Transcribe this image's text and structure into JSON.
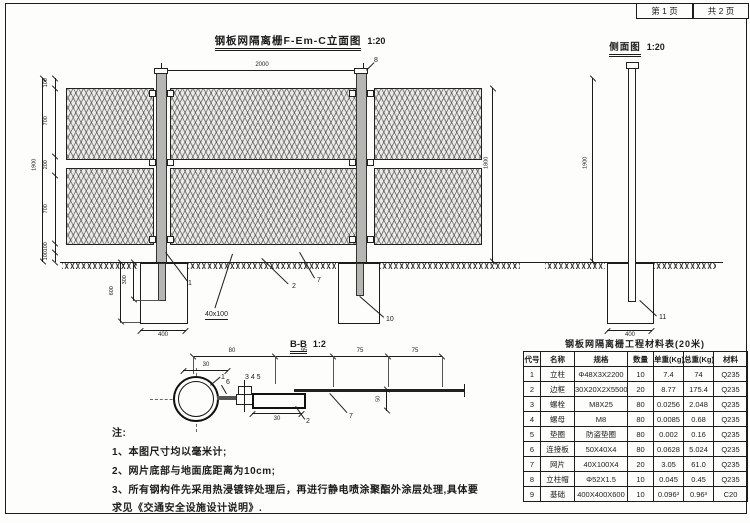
{
  "sheet": {
    "page_no": "第 1 页",
    "page_total": "共 2 页"
  },
  "elevation": {
    "title": "钢板网隔离栅F-Em-C立面图",
    "scale": "1:20",
    "dims": {
      "top_width": "2000",
      "total_height": "1900",
      "chain": [
        "100",
        "700",
        "200",
        "700",
        "100",
        "100"
      ],
      "mesh_height": "1800",
      "foundation_depth": "600",
      "post_embed": "300",
      "foundation_width": "400",
      "mesh_opening": "40x100"
    },
    "callouts": {
      "post": "1",
      "frame": "2",
      "mesh": "7",
      "post_cap": "8",
      "foundation": "10"
    }
  },
  "side_view": {
    "title": "侧面图",
    "scale": "1:20",
    "dims": {
      "post_height": "1900",
      "foundation_width": "400"
    },
    "callouts": {
      "foundation": "11"
    }
  },
  "section_bb": {
    "title": "B-B",
    "scale": "1:2",
    "dims": {
      "top": [
        "80",
        "95",
        "75",
        "75"
      ],
      "offset_top": "30",
      "frame_width": "30",
      "overlap": "50"
    },
    "callouts": {
      "post": "1",
      "frame": "2",
      "bolt_set": "3 4 5",
      "plate": "6",
      "mesh": "7"
    }
  },
  "notes": {
    "heading": "注:",
    "lines": [
      "1、本图尺寸均以毫米计;",
      "2、网片底部与地面底距离为10cm;",
      "3、所有钢构件先采用热浸镀锌处理后，再进行静电喷涂聚酯外涂层处理,具体要",
      "求见《交通安全设施设计说明》."
    ]
  },
  "materials_table": {
    "title": "钢板网隔离栅工程材料表(20米)",
    "headers": [
      "代号",
      "名称",
      "规格",
      "数量",
      "单重(Kg)",
      "总重(Kg)",
      "材料"
    ],
    "rows": [
      [
        "1",
        "立柱",
        "Φ48X3X2200",
        "10",
        "7.4",
        "74",
        "Q235"
      ],
      [
        "2",
        "边框",
        "30X20X2X5500",
        "20",
        "8.77",
        "175.4",
        "Q235"
      ],
      [
        "3",
        "螺栓",
        "M8X25",
        "80",
        "0.0256",
        "2.048",
        "Q235"
      ],
      [
        "4",
        "螺母",
        "M8",
        "80",
        "0.0085",
        "0.68",
        "Q235"
      ],
      [
        "5",
        "垫圈",
        "防盗垫圈",
        "80",
        "0.002",
        "0.16",
        "Q235"
      ],
      [
        "6",
        "连接板",
        "50X40X4",
        "80",
        "0.0628",
        "5.024",
        "Q235"
      ],
      [
        "7",
        "网片",
        "40X100X4",
        "20",
        "3.05",
        "61.0",
        "Q235"
      ],
      [
        "8",
        "立柱帽",
        "Φ52X1.5",
        "10",
        "0.045",
        "0.45",
        "Q235"
      ],
      [
        "9",
        "基础",
        "400X400X600",
        "10",
        "0.096³",
        "0.96³",
        "C20"
      ]
    ]
  }
}
